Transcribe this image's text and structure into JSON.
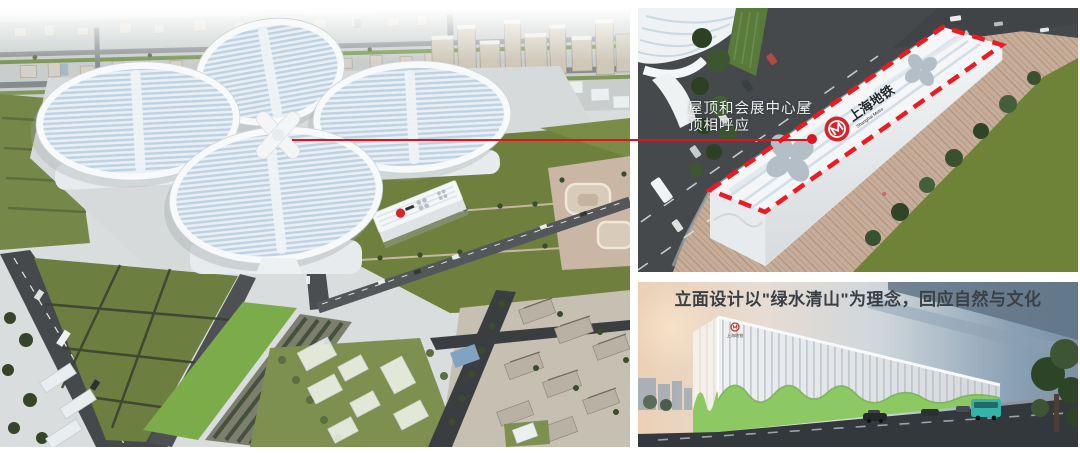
{
  "annotations": {
    "roof_note": {
      "lines": [
        "屋顶和会展中心屋",
        "顶相呼应"
      ],
      "text_color": "#eeeeee"
    },
    "facade_caption": {
      "text": "立面设计以\"绿水清山\"为理念，回应自然与文化",
      "text_color": "#3b4045"
    }
  },
  "logos": {
    "shanghai_metro_roof": {
      "zh": "上海地铁",
      "en": "Shanghai Metro"
    },
    "shanghai_metro_facade": {
      "zh": "上海地铁"
    }
  },
  "colors": {
    "callout_red": "#e0121c",
    "roof_dash_red": "#ee1a22",
    "metro_brand_red": "#d8232a",
    "lawn_green": "#6f8338",
    "site_parcel_green": "#7cab49",
    "facade_wave_green": "#8cc963",
    "road_asphalt": "#45494c",
    "paving_tan": "#c7ae9a",
    "hall_roof_stripe_blue": "#bed2e2",
    "bus_teal": "#35b3a9"
  }
}
